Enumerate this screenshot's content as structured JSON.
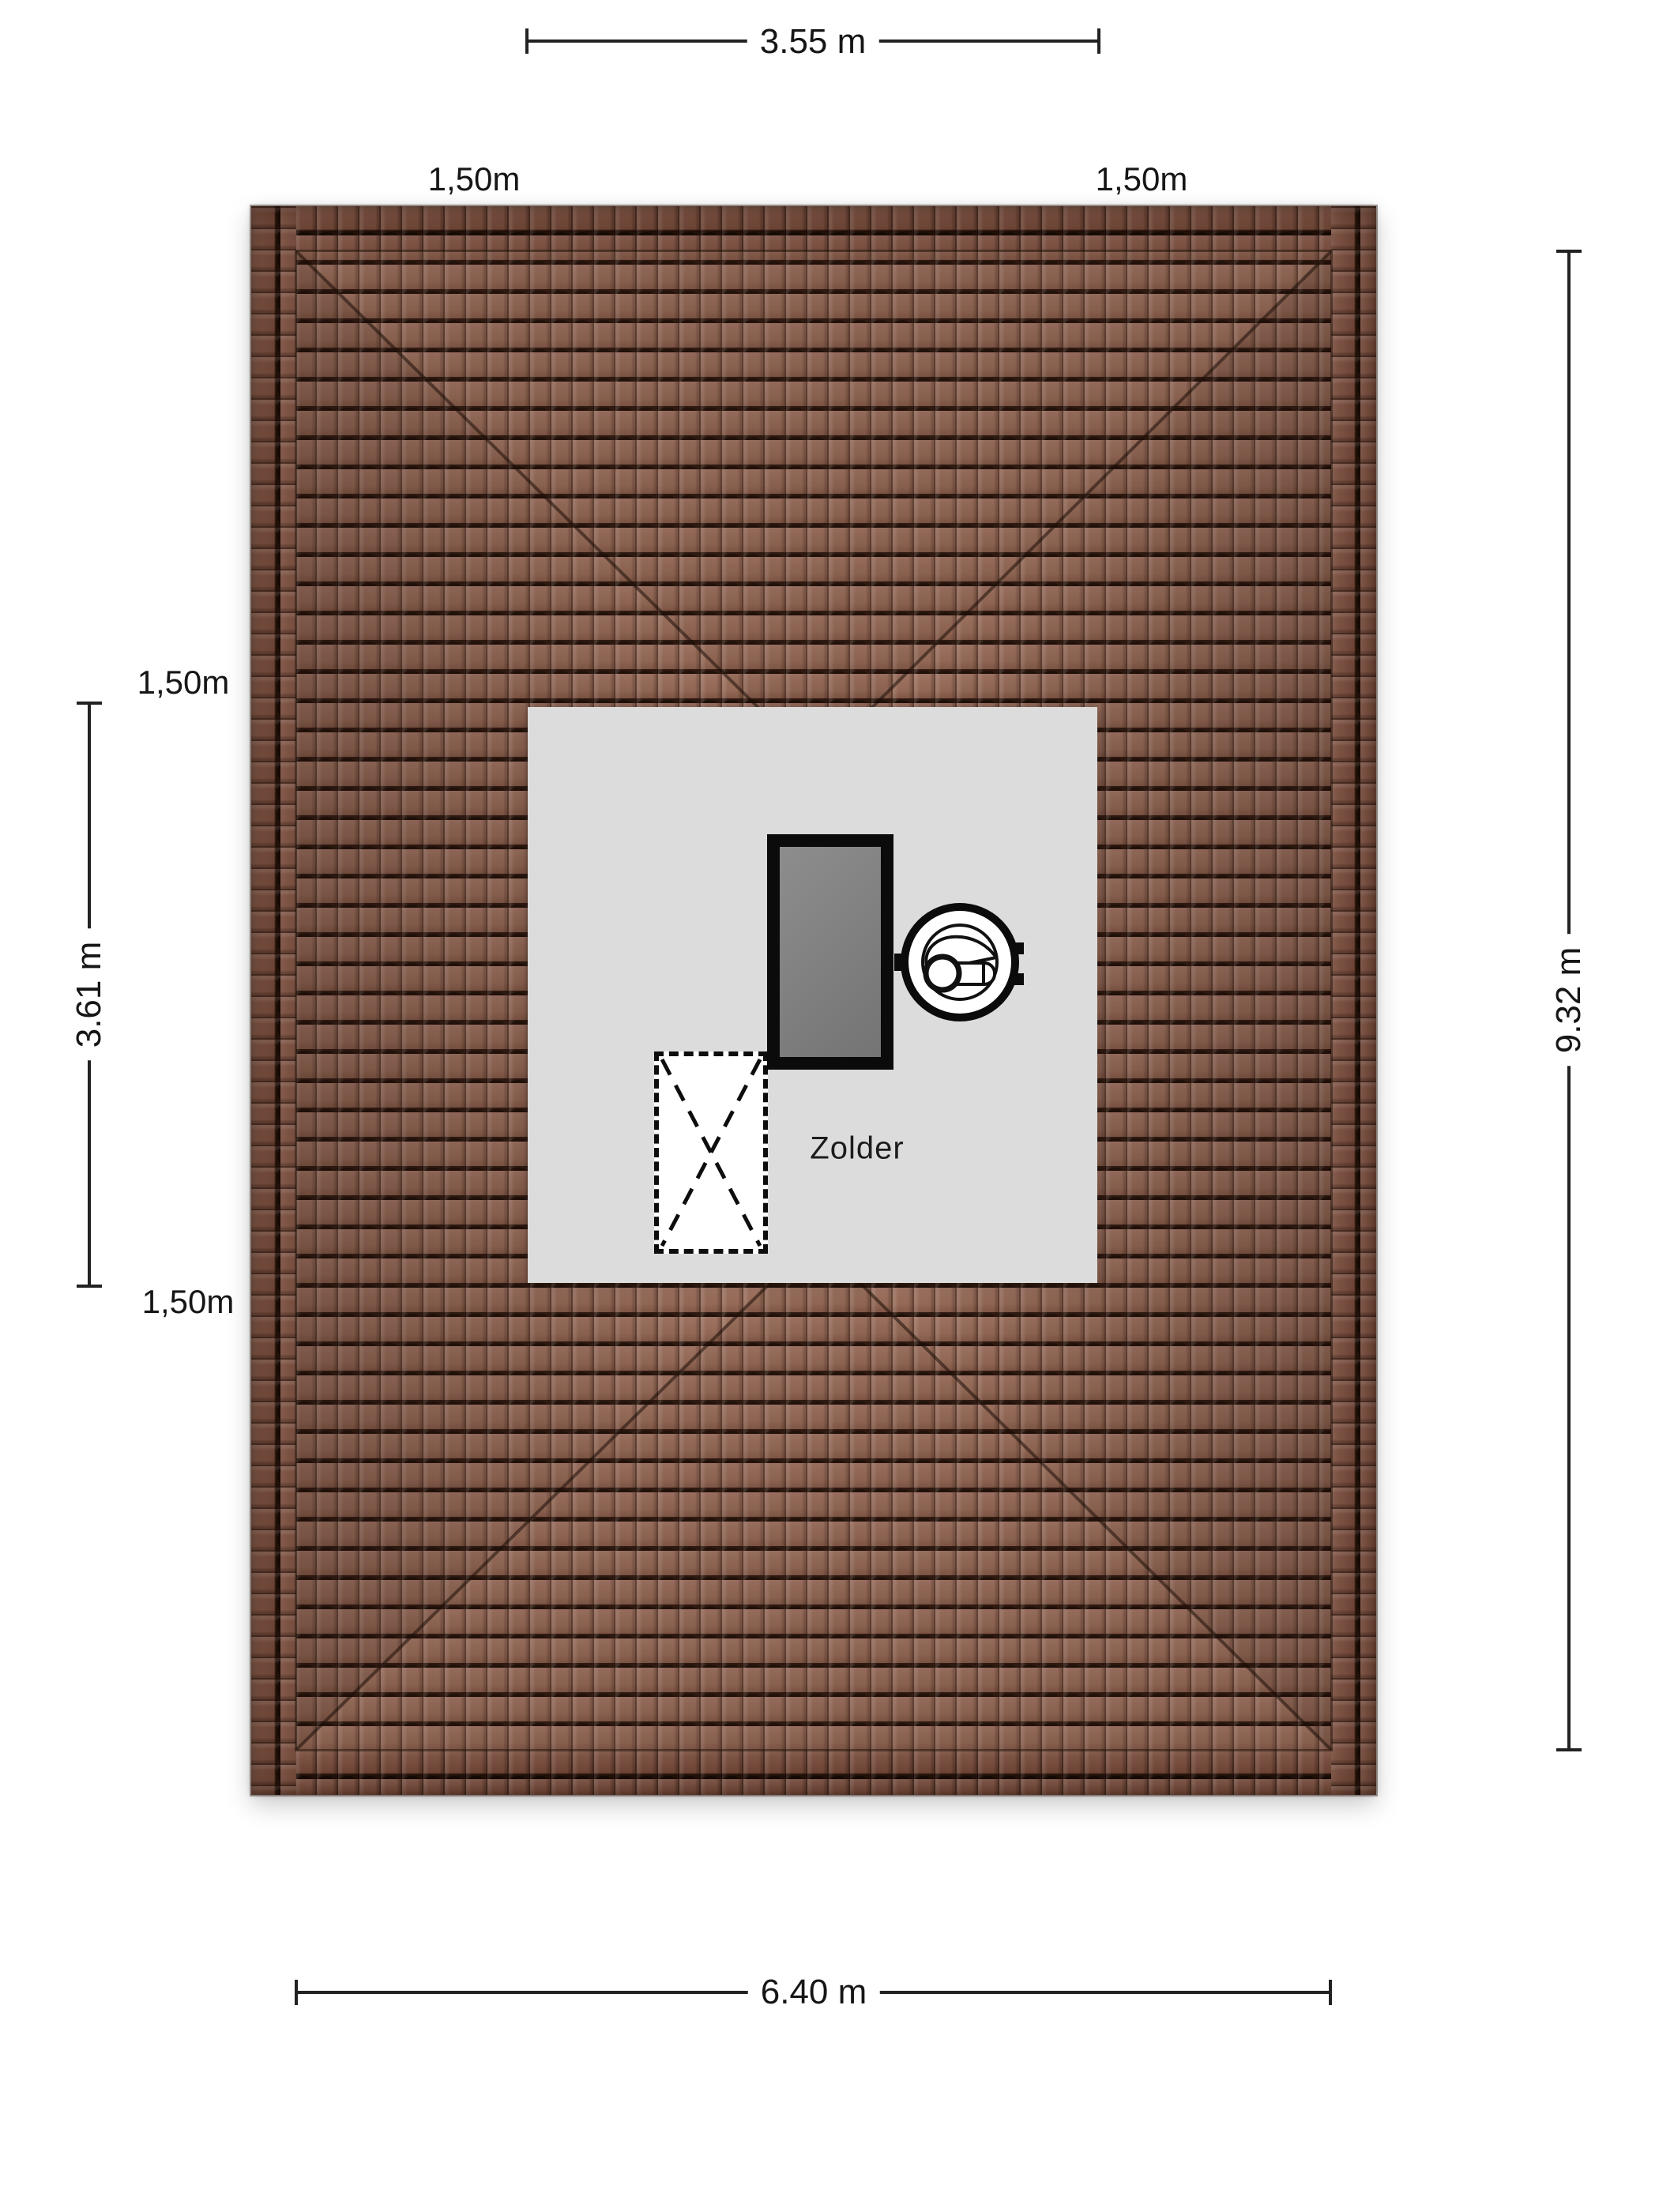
{
  "plan": {
    "type": "floor-plan-top-view",
    "floor_label": "Zolder"
  },
  "room": {
    "label": "Zolder"
  },
  "dimensions": {
    "top": {
      "label": "3.55 m"
    },
    "left": {
      "label": "3.61 m"
    },
    "right": {
      "label": "9.32 m"
    },
    "bottom": {
      "label": "6.40 m"
    },
    "offsets": {
      "top_left": {
        "label": "1,50m"
      },
      "top_right": {
        "label": "1,50m"
      },
      "left_upper": {
        "label": "1,50m"
      },
      "left_lower": {
        "label": "1,50m"
      }
    }
  },
  "icons": {
    "washing_machine": "washing-machine-icon",
    "stairs_hatch": "stairs-hatch-dashed",
    "roof_window": "roof-window-skylight"
  },
  "colors": {
    "background": "#ffffff",
    "roof_tile": "#a1735f",
    "roof_tile_edge_band": "#7b5244",
    "tile_gap": "#331d13",
    "room_fill": "#dcdcdc",
    "roof_window_fill": "#7d7d7d",
    "frame_black": "#0b0b0b",
    "dimension_line": "#222222",
    "text": "#161616"
  }
}
